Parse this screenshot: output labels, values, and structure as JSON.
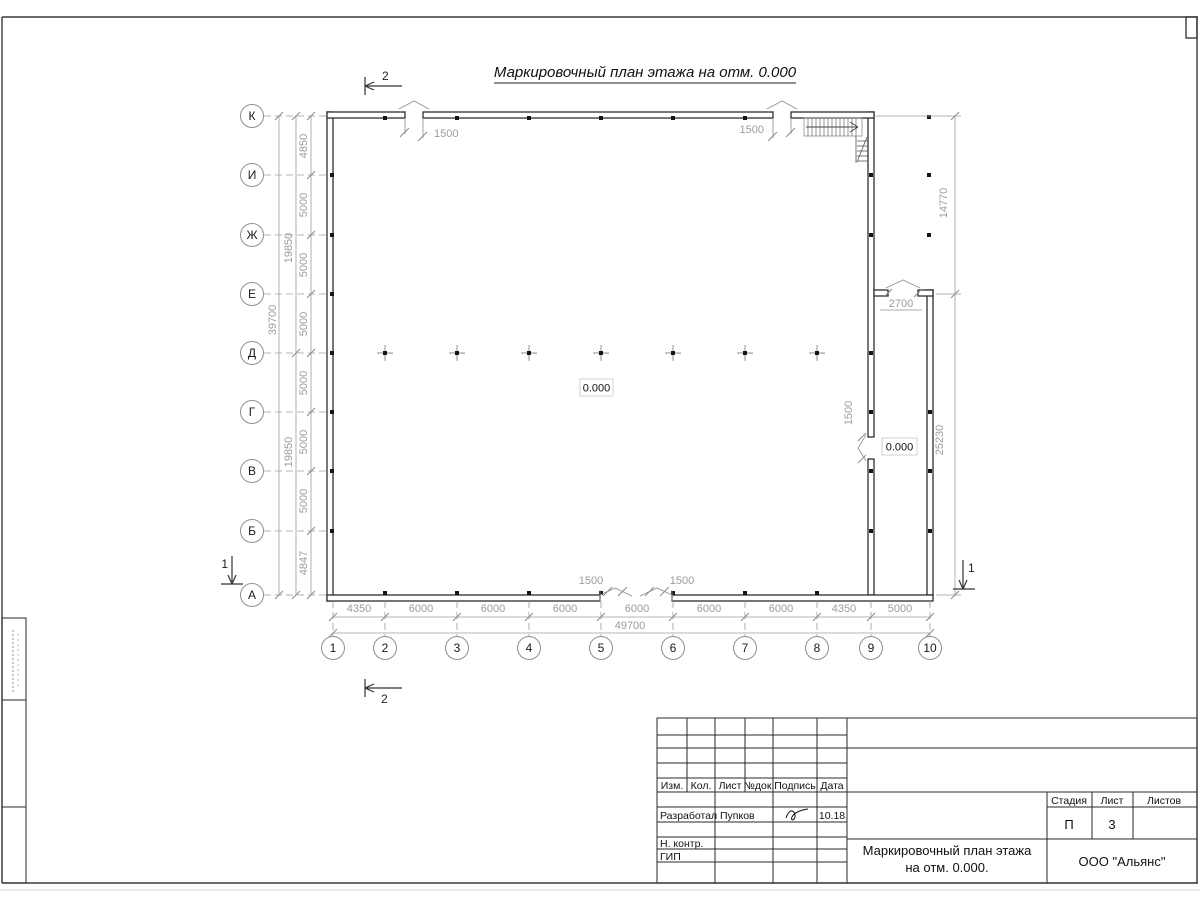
{
  "title": "Маркировочный план этажа на отм. 0.000",
  "axes": {
    "rows": [
      "К",
      "И",
      "Ж",
      "Е",
      "Д",
      "Г",
      "В",
      "Б",
      "А"
    ],
    "cols": [
      "1",
      "2",
      "3",
      "4",
      "5",
      "6",
      "7",
      "8",
      "9",
      "10"
    ]
  },
  "dims": {
    "left_segments": [
      "4850",
      "5000",
      "5000",
      "5000",
      "5000",
      "5000",
      "5000",
      "4847"
    ],
    "left_groups": [
      "19850",
      "19850"
    ],
    "left_total": "39700",
    "right_segments": [
      "14770",
      "25230"
    ],
    "bottom_segments": [
      "4350",
      "6000",
      "6000",
      "6000",
      "6000",
      "6000",
      "6000",
      "4350",
      "5000"
    ],
    "bottom_total": "49700",
    "opening_top_1": "1500",
    "opening_top_2": "1500",
    "opening_bottom_1": "1500",
    "opening_bottom_2": "1500",
    "opening_right": "1500",
    "opening_annex": "2700"
  },
  "elevations": {
    "hall": "0.000",
    "annex": "0.000"
  },
  "sections": {
    "mark_1": "1",
    "mark_2": "2"
  },
  "titleblock": {
    "header": [
      "Изм.",
      "Кол.",
      "Лист",
      "№док.",
      "Подпись",
      "Дата"
    ],
    "developed_label": "Разработал",
    "developed_name": "Пупков",
    "developed_date": "10.18",
    "ncontrol_label": "Н. контр.",
    "gip_label": "ГИП",
    "stage_label": "Стадия",
    "sheet_label": "Лист",
    "sheets_label": "Листов",
    "stage_value": "П",
    "sheet_value": "3",
    "doc_title_line1": "Маркировочный план этажа",
    "doc_title_line2": "на отм. 0.000.",
    "company": "ООО \"Альянс\""
  }
}
